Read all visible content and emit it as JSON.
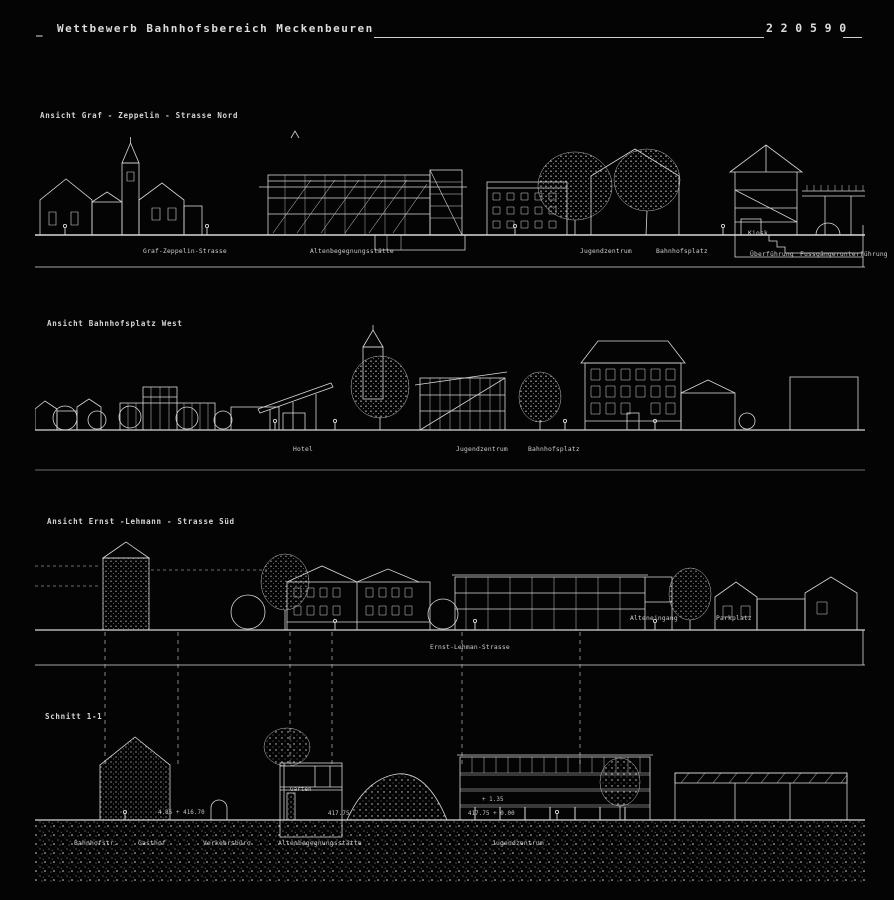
{
  "board": {
    "title_prefix": "_",
    "title": "Wettbewerb Bahnhofsbereich Meckenbeuren",
    "number": "2 2 0 5 9 0"
  },
  "colors": {
    "background": "#040404",
    "ink": "#dcdcdc"
  },
  "panels": [
    {
      "label": "Ansicht Graf - Zeppelin - Strasse  Nord",
      "annotations": [
        "Graf-Zeppelin-Strasse",
        "Altenbegegnungsstätte",
        "Jugendzentrum",
        "Bahnhofsplatz",
        "Kiosk",
        "Überführung",
        "Fussgängerunterführung"
      ]
    },
    {
      "label": "Ansicht Bahnhofsplatz West",
      "annotations": [
        "Hotel",
        "Jugendzentrum",
        "Bahnhofsplatz"
      ]
    },
    {
      "label": "Ansicht Ernst -Lehmann - Strasse  Süd",
      "annotations": [
        "Alteneingang",
        "Parkplatz",
        "Ernst-Lehman-Strasse"
      ]
    },
    {
      "label": "Schnitt 1-1",
      "annotations": [
        "Bahnhofstr.",
        "Gasthof",
        "Verkehrsbüro",
        "Altenbegegnungsstätte",
        "Jugendzentrum"
      ],
      "marks": [
        "4.85 + 416.70",
        "Garten",
        "417.75",
        "417.75 + 0.00",
        "+ 1.35"
      ]
    }
  ]
}
